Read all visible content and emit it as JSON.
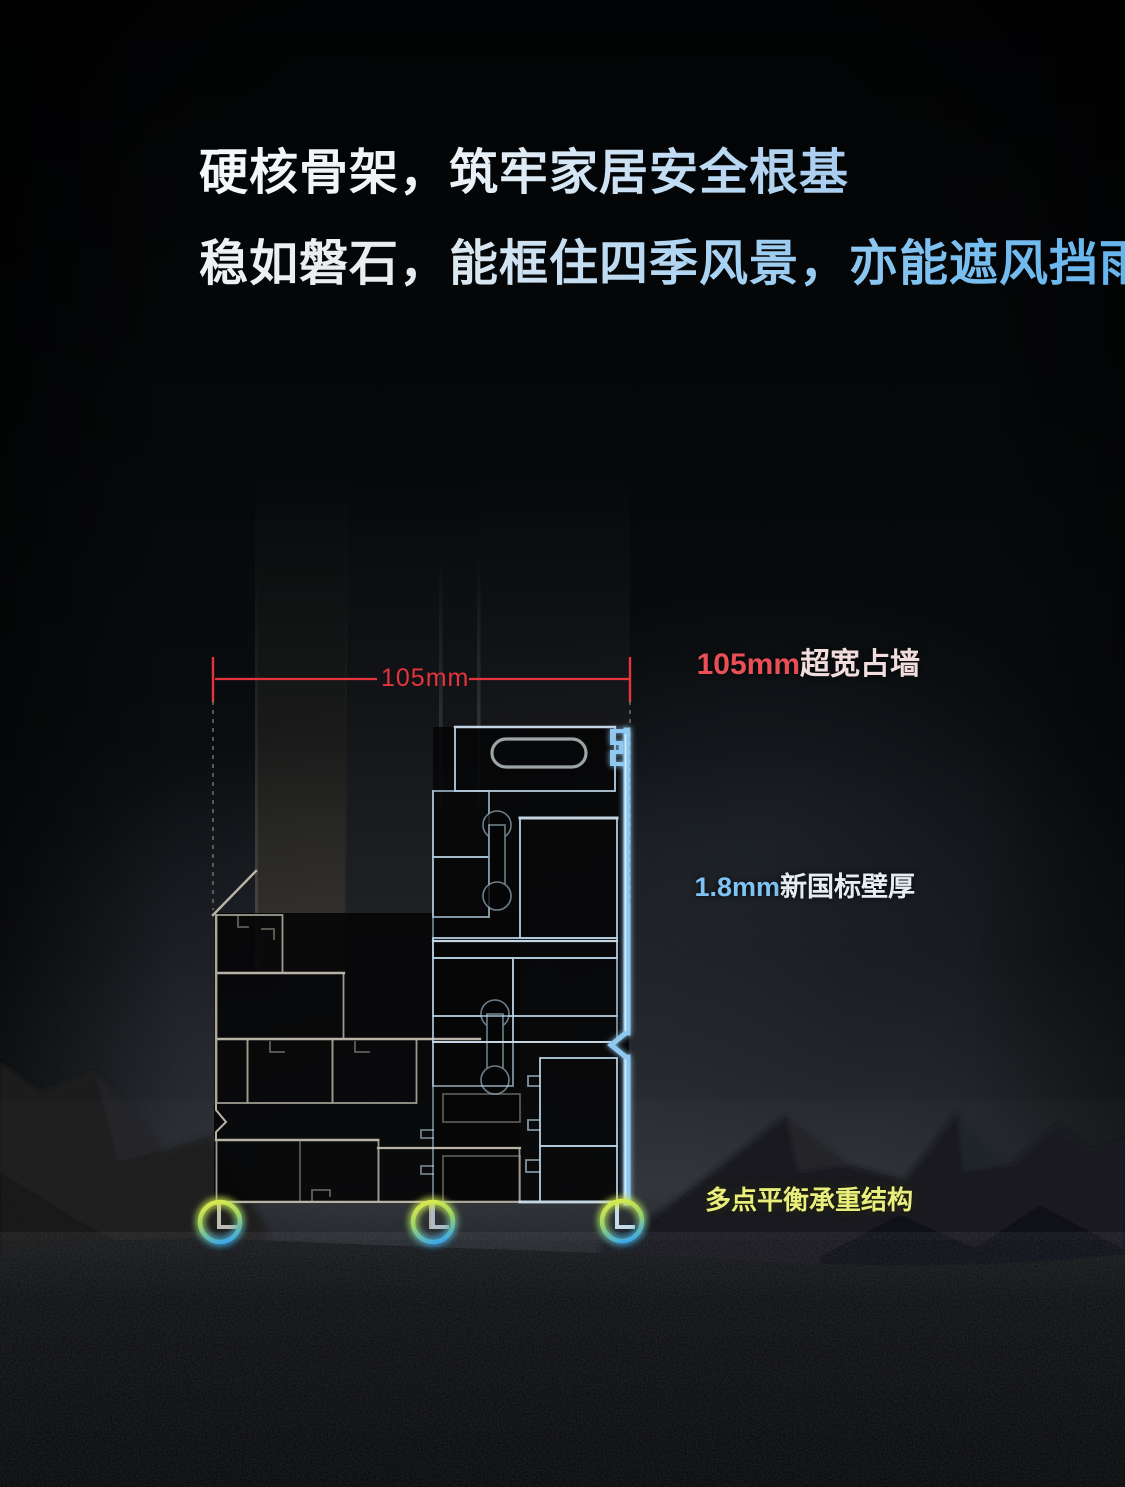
{
  "page": {
    "width": 1125,
    "height": 1487,
    "background": "#07080a",
    "theme": "dark product promo"
  },
  "headline": {
    "line1": "硬核骨架，筑牢家居安全根基",
    "line2": "稳如磐石，能框住四季风景，亦能遮风挡雨",
    "gradient_from": "#f5f7f9",
    "gradient_to": "#62b2ec"
  },
  "diagram": {
    "dimension_label": "105mm",
    "dimension_color": "#e5343c",
    "callouts": [
      {
        "prefix": "105mm",
        "suffix": "超宽占墙",
        "prefix_color": "#e85055",
        "suffix_color": "#f1dddd",
        "line_colors": [
          "#b4262b",
          "#8e9498"
        ]
      },
      {
        "prefix": "1.8mm",
        "suffix": "新国标壁厚",
        "prefix_color": "#7fc2f4",
        "suffix_color": "#e4edf4",
        "line_colors": [
          "#57a9da",
          "#ecf3fa"
        ]
      },
      {
        "prefix": "",
        "suffix": "多点平衡承重结构",
        "prefix_color": "",
        "suffix_color": "#e9ee7d",
        "line_colors": [
          "#4db0e6",
          "#f4f8fa"
        ]
      }
    ],
    "profile_colors": {
      "left_outline": "#a6a195",
      "right_outline": "#bdd8ea",
      "edge_highlight": "#8fc8f0",
      "ring_gradient_top": "#d6e94e",
      "ring_gradient_bottom": "#3da8e8"
    }
  }
}
